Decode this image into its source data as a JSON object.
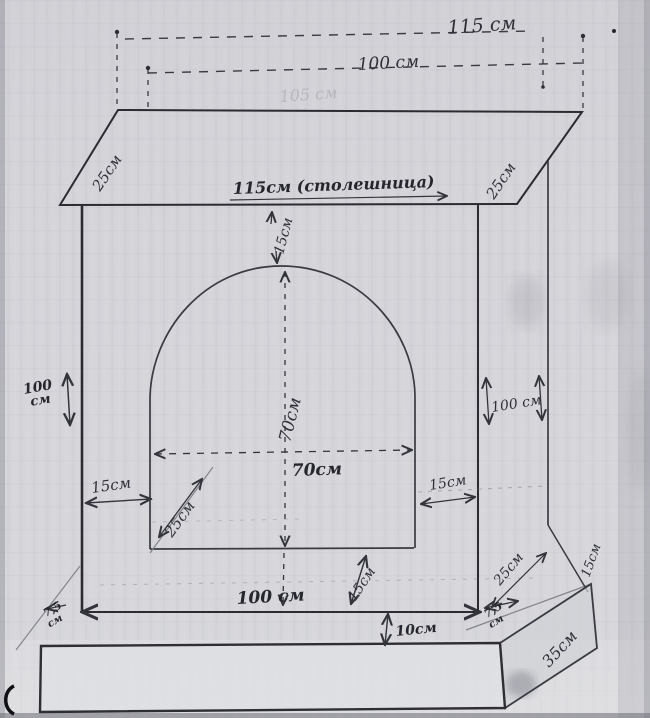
{
  "drawing": {
    "top_view": {
      "width": "115 см",
      "depth": "100 см",
      "erased": "105 см"
    },
    "countertop": {
      "front": "115см (столешница)",
      "left_edge": "25см",
      "right_edge": "25см"
    },
    "gap_above_arch": "15см",
    "left_side": {
      "height_value": "100",
      "height_unit": "см",
      "column_width": "15см"
    },
    "right_side": {
      "height": "100 см",
      "column_width": "15см"
    },
    "firebox": {
      "height": "70см",
      "width": "70см",
      "jamb_depth": "25см"
    },
    "base": {
      "body_width": "100 см",
      "hearth_rise": "15см",
      "step_depth": "25см",
      "step_side": "15см",
      "plinth_height": "10см",
      "overhang_left_value": "7,5",
      "overhang_left_unit": "см",
      "overhang_right_value": "7,5",
      "overhang_right_unit": "см",
      "plinth_depth": "35см"
    }
  }
}
